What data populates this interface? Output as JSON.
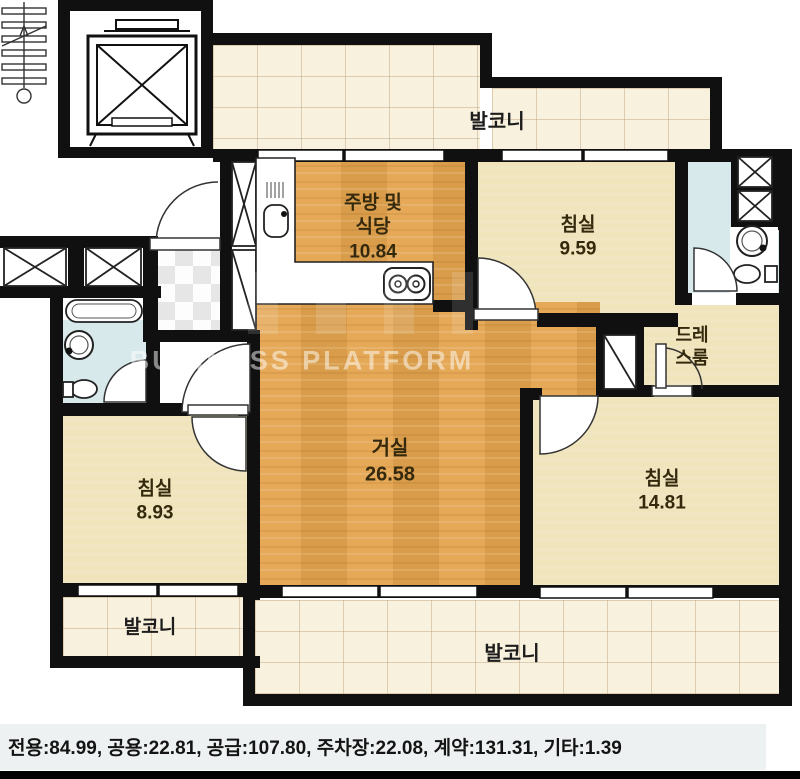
{
  "watermark": {
    "text": "BUSINESS PLATFORM"
  },
  "rooms": {
    "balcony_top": {
      "label": "발코니"
    },
    "balcony_left": {
      "label": "발코니"
    },
    "balcony_bottom": {
      "label": "발코니"
    },
    "kitchen": {
      "label_line1": "주방 및",
      "label_line2": "식당",
      "area": "10.84"
    },
    "bedroom_top": {
      "label": "침실",
      "area": "9.59"
    },
    "bedroom_left": {
      "label": "침실",
      "area": "8.93"
    },
    "bedroom_right": {
      "label": "침실",
      "area": "14.81"
    },
    "living": {
      "label": "거실",
      "area": "26.58"
    },
    "dressroom": {
      "label_line1": "드레",
      "label_line2": "스룸"
    }
  },
  "footer": {
    "caption": "전용:84.99, 공용:22.81, 공급:107.80, 주차장:22.08, 계약:131.31, 기타:1.39"
  },
  "icons": {
    "stairs": "stairs-icon",
    "elevator": "elevator-icon",
    "stove": "stove-icon",
    "kitchen_sink": "kitchen-sink-icon",
    "bathtub": "bathtub-icon",
    "wash_basin": "wash-basin-icon",
    "toilet": "toilet-icon",
    "closet": "closet-x-icon",
    "door": "door-arc-icon"
  },
  "colors": {
    "wall": "#111111",
    "wood_floor": "#E4A44E",
    "room_floor": "#F0E4BC",
    "balcony_floor": "#F8F1DE",
    "bath_floor": "#D8E9EC",
    "label_text": "#35290D",
    "watermark": "#FFFFFF"
  }
}
